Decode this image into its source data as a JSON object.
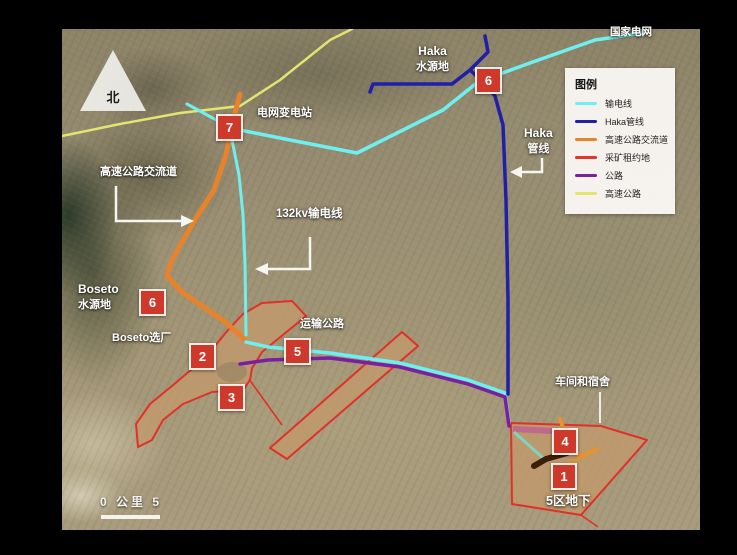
{
  "north": {
    "label": "北"
  },
  "scalebar": {
    "label": "0 公里 5"
  },
  "legend": {
    "title": "图例",
    "items": [
      {
        "label": "输电线",
        "color": "#6ff0f0"
      },
      {
        "label": "Haka管线",
        "color": "#1f1fa8"
      },
      {
        "label": "高速公路交流道",
        "color": "#e8832b"
      },
      {
        "label": "采矿租约地",
        "color": "#e0352a"
      },
      {
        "label": "公路",
        "color": "#7a1fa0"
      },
      {
        "label": "高速公路",
        "color": "#e4e470"
      }
    ]
  },
  "labels": {
    "national_grid": "国家电网",
    "haka_water_line1": "Haka",
    "haka_water_line2": "水源地",
    "substation": "电网变电站",
    "interchange": "高速公路交流道",
    "kv_line": "132kv输电线",
    "haka_pipe_line1": "Haka",
    "haka_pipe_line2": "管线",
    "boseto_water_line1": "Boseto",
    "boseto_water_line2": "水源地",
    "boseto_plant": "Boseto选厂",
    "transport_road": "运输公路",
    "workshop": "车间和宿舍",
    "zone5": "5区地下"
  },
  "markers": [
    {
      "number": "7"
    },
    {
      "number": "6"
    },
    {
      "number": "6"
    },
    {
      "number": "2"
    },
    {
      "number": "3"
    },
    {
      "number": "5"
    },
    {
      "number": "4"
    },
    {
      "number": "1"
    }
  ]
}
